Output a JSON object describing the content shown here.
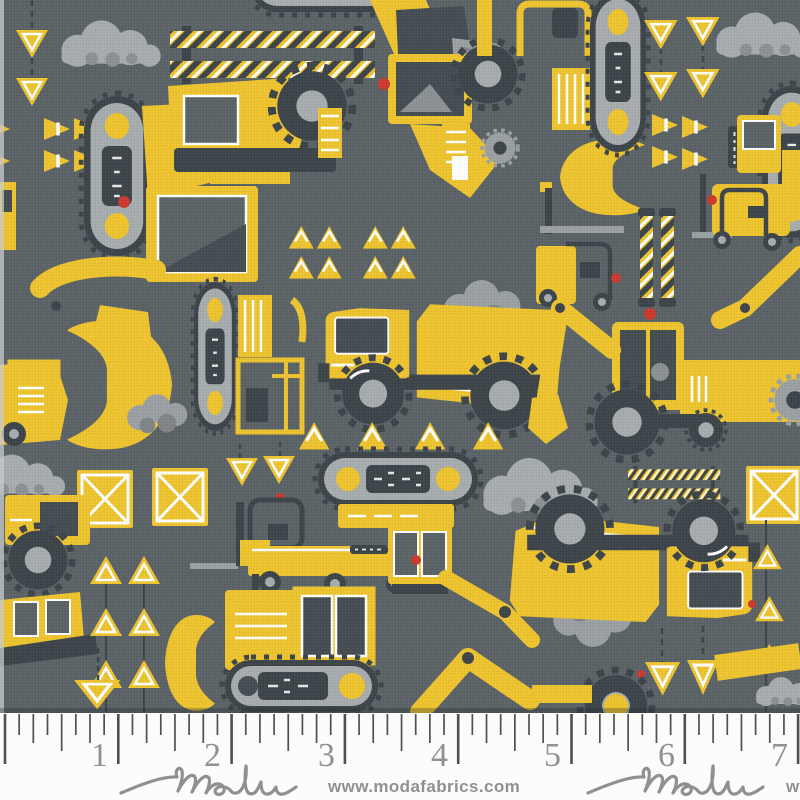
{
  "fabric": {
    "description_label": "construction equipment print fabric",
    "colors": {
      "background": "#5b6367",
      "yellow": "#eec42f",
      "light_gray": "#a7acae",
      "mid_gray": "#8b9194",
      "dark_slate": "#3d454a",
      "window_slate": "#454d52",
      "white": "#ffffff",
      "red": "#cc3a2f",
      "selvage_white": "#fcfcfa"
    },
    "motifs": [
      "dump-truck",
      "excavator",
      "wheel-loader",
      "backhoe-tractor",
      "bulldozer",
      "forklift",
      "boom-lift",
      "crawler-track",
      "traffic-cone",
      "warning-triangle-sign",
      "inverted-triangle-sign",
      "crate",
      "striped-barricade",
      "striped-pole",
      "dirt-cloud",
      "gravel-pile",
      "caution-sign",
      "beacon-light",
      "plow-blade"
    ]
  },
  "ruler": {
    "numbers": [
      "1",
      "2",
      "3",
      "4",
      "5",
      "6",
      "7"
    ],
    "start_x": 5,
    "inch_spacing": 113.3,
    "divisions_per_inch": 8,
    "tick_count": 57
  },
  "footer": {
    "brand": "moda",
    "url": "www.modafabrics.com"
  }
}
